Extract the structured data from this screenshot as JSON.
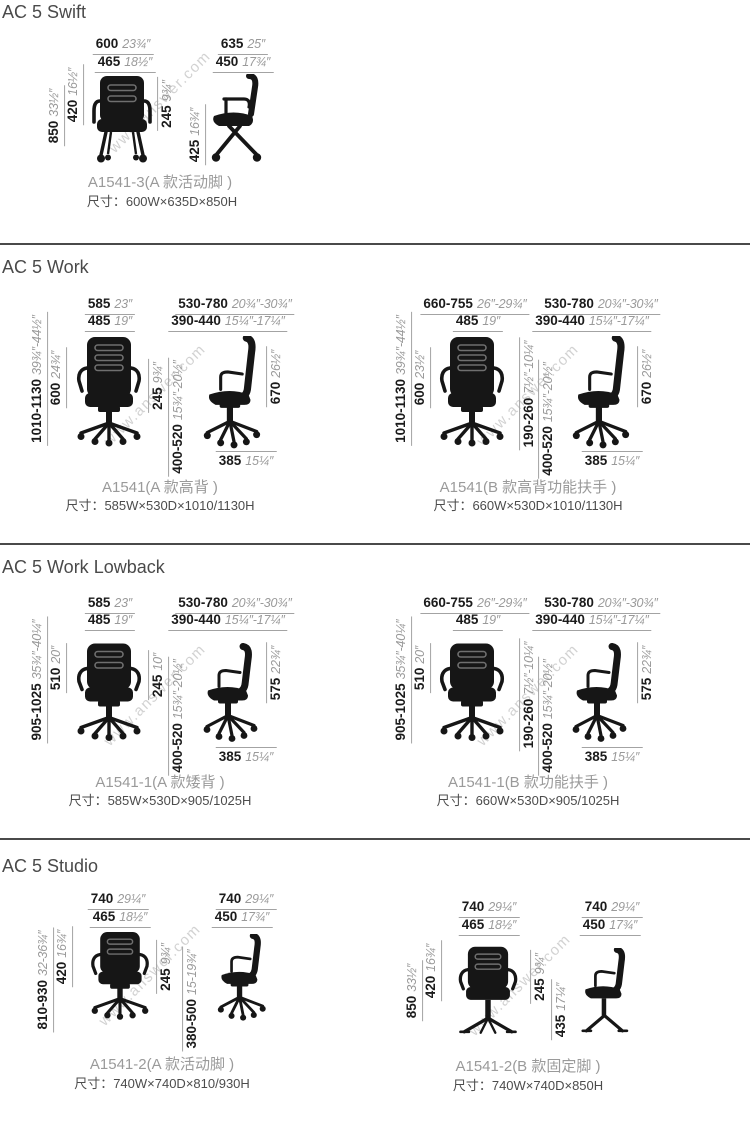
{
  "watermark": "www.answer.com",
  "sections": [
    {
      "title": "AC 5 Swift",
      "figures": [
        {
          "caption": "A1541-3(A 款活动脚 )",
          "size": "尺寸：600W×635D×850H",
          "dims": {
            "front_top1": {
              "mm": "600",
              "in": "23¾″"
            },
            "front_top2": {
              "mm": "465",
              "in": "18½″"
            },
            "left_outer": {
              "mm": "850",
              "in": "33½″"
            },
            "left_inner": {
              "mm": "420",
              "in": "16½″"
            },
            "right1": {
              "mm": "245",
              "in": "9¾″"
            },
            "side_top1": {
              "mm": "635",
              "in": "25″"
            },
            "side_top2": {
              "mm": "450",
              "in": "17¾″"
            },
            "side_left": {
              "mm": "425",
              "in": "16¾″"
            }
          }
        }
      ]
    },
    {
      "title": "AC 5 Work",
      "figures": [
        {
          "caption": "A1541(A 款高背 )",
          "size": "尺寸：585W×530D×1010/1130H",
          "dims": {
            "front_top1": {
              "mm": "585",
              "in": "23″"
            },
            "front_top2": {
              "mm": "485",
              "in": "19″"
            },
            "left_outer": {
              "mm": "1010-1130",
              "in": "39¾″-44½″"
            },
            "left_inner": {
              "mm": "600",
              "in": "24¾″"
            },
            "right1": {
              "mm": "245",
              "in": "9¾″"
            },
            "mid2": {
              "mm": "400-520",
              "in": "15¾″-20½″"
            },
            "side_top1": {
              "mm": "530-780",
              "in": "20¾″-30¾″"
            },
            "side_top2": {
              "mm": "390-440",
              "in": "15¼″-17¼″"
            },
            "side_right": {
              "mm": "670",
              "in": "26½″"
            },
            "side_bottom": {
              "mm": "385",
              "in": "15¼″"
            }
          }
        },
        {
          "caption": "A1541(B 款高背功能扶手 )",
          "size": "尺寸：660W×530D×1010/1130H",
          "dims": {
            "front_top1": {
              "mm": "660-755",
              "in": "26″-29¾″"
            },
            "front_top2": {
              "mm": "485",
              "in": "19″"
            },
            "left_outer": {
              "mm": "1010-1130",
              "in": "39¾″-44½″"
            },
            "left_inner": {
              "mm": "600",
              "in": "23½″"
            },
            "mid1": {
              "mm": "190-260",
              "in": "7½″-10¼″"
            },
            "mid2": {
              "mm": "400-520",
              "in": "15¾″-20½″"
            },
            "side_top1": {
              "mm": "530-780",
              "in": "20¾″-30¾″"
            },
            "side_top2": {
              "mm": "390-440",
              "in": "15¼″-17¼″"
            },
            "side_right": {
              "mm": "670",
              "in": "26½″"
            },
            "side_bottom": {
              "mm": "385",
              "in": "15¼″"
            }
          }
        }
      ]
    },
    {
      "title": "AC 5 Work Lowback",
      "figures": [
        {
          "caption": "A1541-1(A 款矮背 )",
          "size": "尺寸：585W×530D×905/1025H",
          "dims": {
            "front_top1": {
              "mm": "585",
              "in": "23″"
            },
            "front_top2": {
              "mm": "485",
              "in": "19″"
            },
            "left_outer": {
              "mm": "905-1025",
              "in": "35¾″-40¼″"
            },
            "left_inner": {
              "mm": "510",
              "in": "20″"
            },
            "right1": {
              "mm": "245",
              "in": "10″"
            },
            "mid2": {
              "mm": "400-520",
              "in": "15¾″-20½″"
            },
            "side_top1": {
              "mm": "530-780",
              "in": "20¾″-30¾″"
            },
            "side_top2": {
              "mm": "390-440",
              "in": "15¼″-17¼″"
            },
            "side_right": {
              "mm": "575",
              "in": "22¾″"
            },
            "side_bottom": {
              "mm": "385",
              "in": "15¼″"
            }
          }
        },
        {
          "caption": "A1541-1(B 款功能扶手 )",
          "size": "尺寸：660W×530D×905/1025H",
          "dims": {
            "front_top1": {
              "mm": "660-755",
              "in": "26″-29¾″"
            },
            "front_top2": {
              "mm": "485",
              "in": "19″"
            },
            "left_outer": {
              "mm": "905-1025",
              "in": "35¾″-40¼″"
            },
            "left_inner": {
              "mm": "510",
              "in": "20″"
            },
            "mid1": {
              "mm": "190-260",
              "in": "7½″-10¼″"
            },
            "mid2": {
              "mm": "400-520",
              "in": "15¾″-20½″"
            },
            "side_top1": {
              "mm": "530-780",
              "in": "20¾″-30¾″"
            },
            "side_top2": {
              "mm": "390-440",
              "in": "15¼″-17¼″"
            },
            "side_right": {
              "mm": "575",
              "in": "22¾″"
            },
            "side_bottom": {
              "mm": "385",
              "in": "15¼″"
            }
          }
        }
      ]
    },
    {
      "title": "AC 5 Studio",
      "figures": [
        {
          "caption": "A1541-2(A 款活动脚 )",
          "size": "尺寸：740W×740D×810/930H",
          "dims": {
            "front_top1": {
              "mm": "740",
              "in": "29¼″"
            },
            "front_top2": {
              "mm": "465",
              "in": "18½″"
            },
            "left_outer": {
              "mm": "810-930",
              "in": "32-36¾″"
            },
            "left_inner": {
              "mm": "420",
              "in": "16¾″"
            },
            "right1": {
              "mm": "245",
              "in": "9¾″"
            },
            "right2": {
              "mm": "380-500",
              "in": "15-19¾″"
            },
            "side_top1": {
              "mm": "740",
              "in": "29¼″"
            },
            "side_top2": {
              "mm": "450",
              "in": "17¾″"
            }
          }
        },
        {
          "caption": "A1541-2(B 款固定脚 )",
          "size": "尺寸：740W×740D×850H",
          "dims": {
            "front_top1": {
              "mm": "740",
              "in": "29¼″"
            },
            "front_top2": {
              "mm": "465",
              "in": "18½″"
            },
            "left_outer": {
              "mm": "850",
              "in": "33½″"
            },
            "left_inner": {
              "mm": "420",
              "in": "16¾″"
            },
            "right1": {
              "mm": "245",
              "in": "9¾″"
            },
            "right2": {
              "mm": "435",
              "in": "17¼″"
            },
            "side_top1": {
              "mm": "740",
              "in": "29¼″"
            },
            "side_top2": {
              "mm": "450",
              "in": "17¾″"
            }
          }
        }
      ]
    }
  ]
}
